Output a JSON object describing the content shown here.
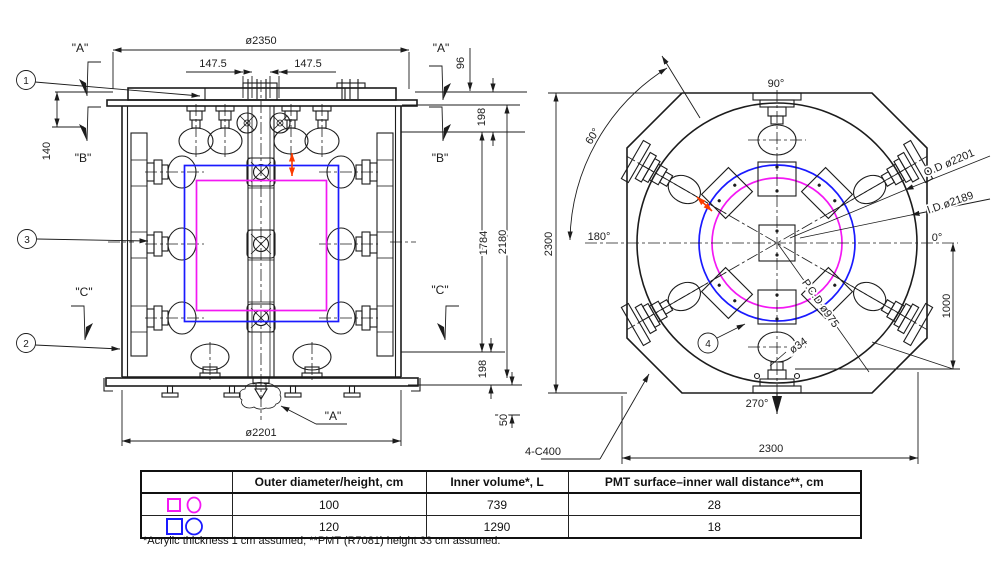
{
  "lv": {
    "b1": "1",
    "b2": "2",
    "b3": "3",
    "sec_a_tl": "\"A\"",
    "sec_a_tr": "\"A\"",
    "sec_a_bottom": "\"A\"",
    "sec_b_l": "\"B\"",
    "sec_b_r": "\"B\"",
    "sec_c_l": "\"C\"",
    "sec_c_r": "\"C\"",
    "dia_top": "ø2350",
    "off_l": "147.5",
    "off_r": "147.5",
    "d96": "96",
    "d198t": "198",
    "d140": "140",
    "d1784": "1784",
    "d2180": "2180",
    "d198b": "198",
    "d50": "50",
    "dia_bot": "ø2201"
  },
  "rv": {
    "b4": "4",
    "a90": "90°",
    "a60": "60°",
    "a180": "180°",
    "a0": "0°",
    "a270": "270°",
    "od": "O.D ø2201",
    "idd": "I.D ø2189",
    "pcd": "P.C.D ø975",
    "d34": "ø34",
    "d1000": "1000",
    "h2300": "2300",
    "w2300": "2300",
    "chamfer": "4-C400"
  },
  "table": {
    "headers": [
      "",
      "Outer diameter/height, cm",
      "Inner volume*, L",
      "PMT surface–inner wall distance**, cm"
    ],
    "rows": [
      [
        "100",
        "739",
        "28"
      ],
      [
        "120",
        "1290",
        "18"
      ]
    ],
    "footnote": "*Acrylic thickness 1 cm assumed; **PMT (R7081) height 33 cm assumed."
  },
  "colors": {
    "blue": "#1a1aff",
    "magenta": "#f318f3",
    "red": "#fb3b00",
    "line": "#1c1c1c"
  }
}
